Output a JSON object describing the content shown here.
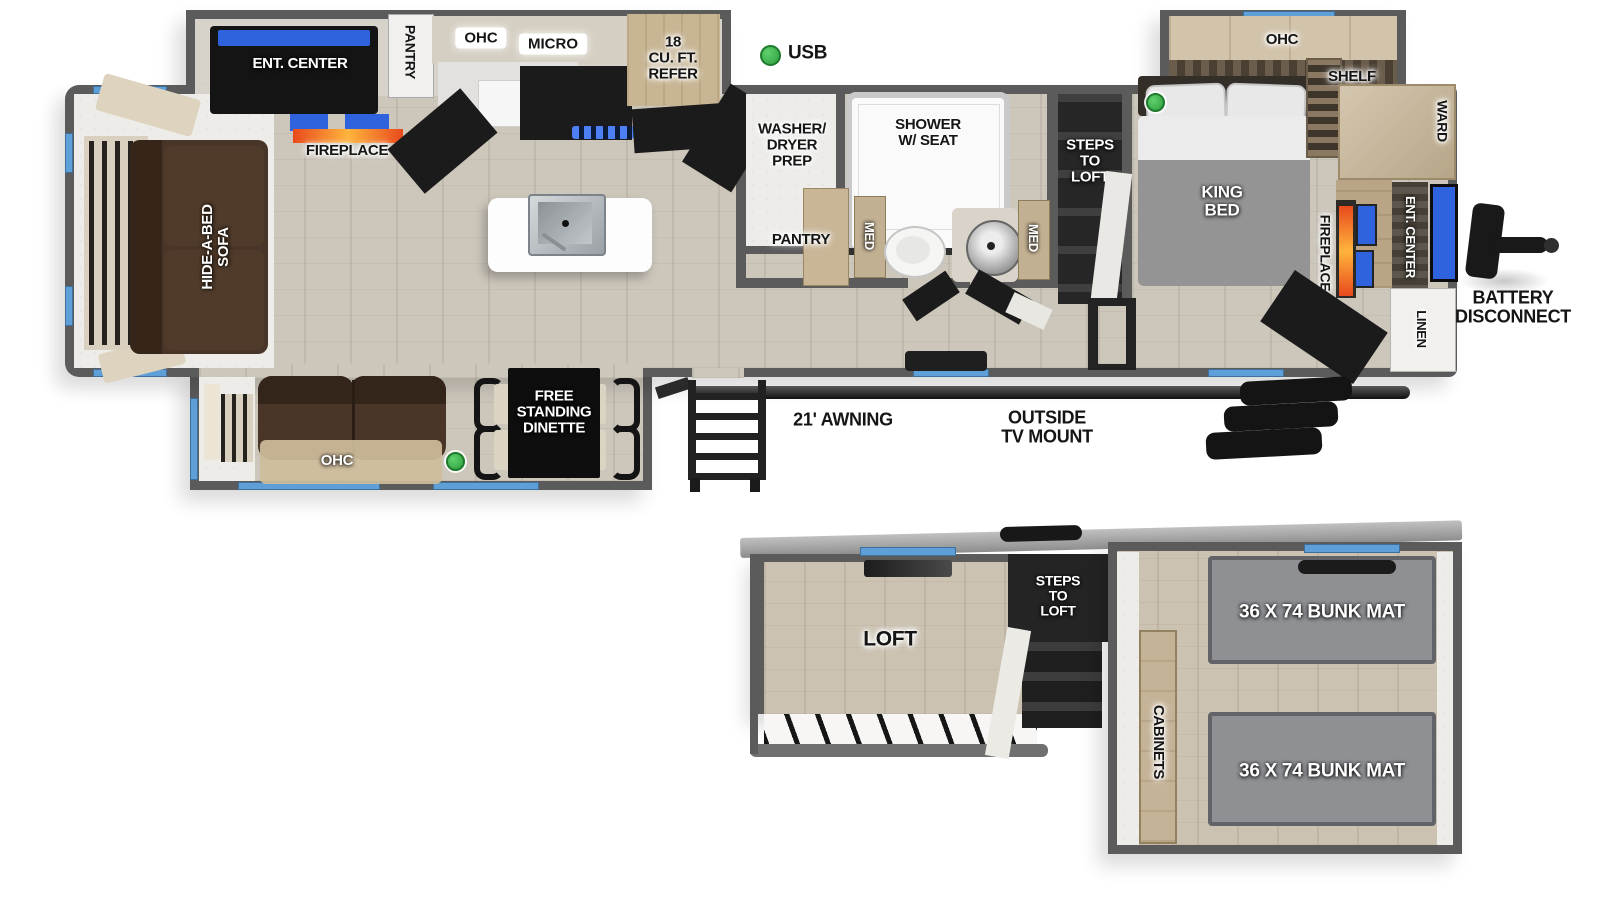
{
  "diagram_type": "RV travel trailer floor plan, main level and loft level",
  "colors": {
    "wall": "#5b5b5b",
    "window": "#5f9fd8",
    "usb_indicator": "#3bb54a",
    "tv_screen": "#2f63dd",
    "fireplace_flame": "#f26522",
    "floor_wood": "#ccc6bb",
    "sofa_brown": "#483527",
    "bunk_mat_gray": "#8e9094"
  },
  "main_floor": {
    "living_area": {
      "ent_center": "ENT. CENTER",
      "fireplace": "FIREPLACE",
      "hide_a_bed_sofa": "HIDE-A-BED\nSOFA"
    },
    "kitchen": {
      "pantry": "PANTRY",
      "ohc": "OHC",
      "micro": "MICRO",
      "refrigerator": "18\nCU. FT.\nREFER"
    },
    "bathroom": {
      "washer_dryer_prep": "WASHER/\nDRYER\nPREP",
      "shower": "SHOWER\nW/ SEAT",
      "pantry": "PANTRY",
      "med_cabinet_left": "MED",
      "med_cabinet_right": "MED"
    },
    "steps_to_loft": "STEPS\nTO\nLOFT",
    "bedroom": {
      "ohc": "OHC",
      "shelf": "SHELF",
      "king_bed": "KING\nBED",
      "ward": "WARD",
      "fireplace": "FIREPLACE",
      "ent_center": "ENT. CENTER",
      "linen": "LINEN"
    },
    "slide_out": {
      "ohc": "OHC",
      "dinette": "FREE\nSTANDING\nDINETTE"
    },
    "exterior": {
      "usb": "USB",
      "awning": "21' AWNING",
      "outside_tv_mount": "OUTSIDE\nTV MOUNT",
      "battery_disconnect": "BATTERY\nDISCONNECT"
    }
  },
  "loft_level": {
    "loft": "LOFT",
    "steps_to_loft": "STEPS\nTO\nLOFT",
    "cabinets": "CABINETS",
    "bunk_mat_top": "36 X 74 BUNK MAT",
    "bunk_mat_bottom": "36 X 74 BUNK MAT"
  }
}
